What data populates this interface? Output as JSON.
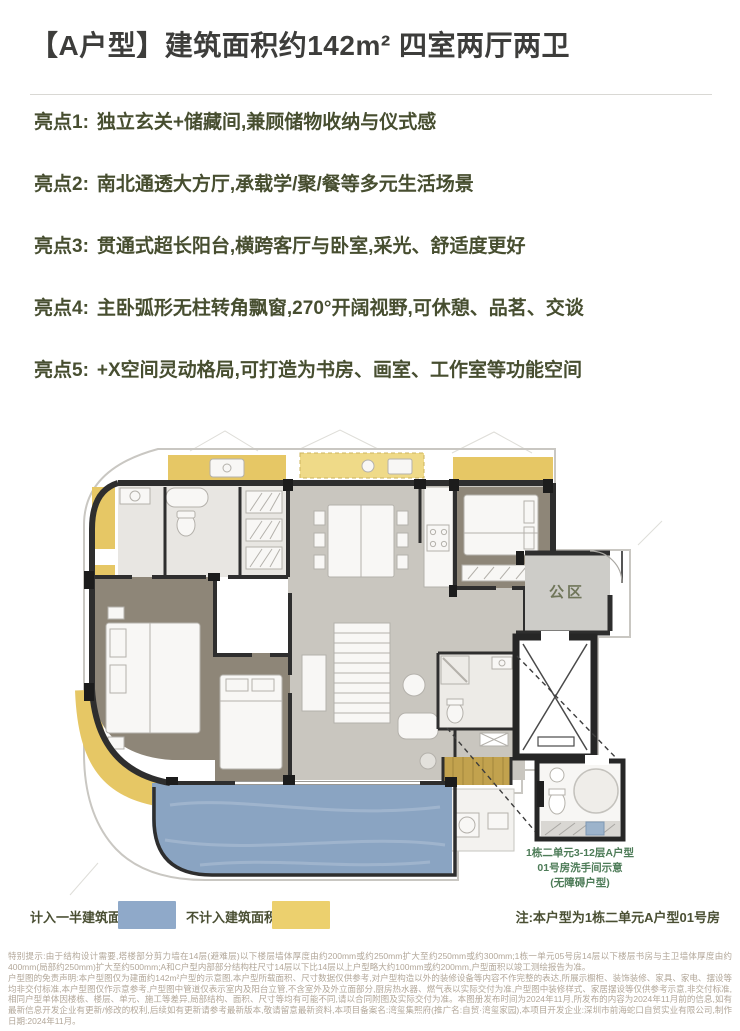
{
  "header": {
    "title": "【A户型】建筑面积约142m² 四室两厅两卫"
  },
  "highlights": [
    {
      "label": "亮点1:",
      "text": "独立玄关+储藏间,兼顾储物收纳与仪式感"
    },
    {
      "label": "亮点2:",
      "text": "南北通透大方厅,承载学/聚/餐等多元生活场景"
    },
    {
      "label": "亮点3:",
      "text": "贯通式超长阳台,横跨客厅与卧室,采光、舒适度更好"
    },
    {
      "label": "亮点4:",
      "text": "主卧弧形无柱转角飘窗,270°开阔视野,可休憩、品茗、交谈"
    },
    {
      "label": "亮点5:",
      "text": "+X空间灵动格局,可打造为书房、画室、工作室等功能空间"
    }
  ],
  "floorplan": {
    "public_area_label": "公区",
    "inset_caption": [
      "1栋二单元3-12层A户型",
      "01号房洗手间示意",
      "(无障碍户型)"
    ]
  },
  "legend": {
    "items": [
      {
        "label": "计入一半建筑面积",
        "color": "#8fa9c9"
      },
      {
        "label": "不计入建筑面积",
        "color": "#ecd06e"
      }
    ],
    "note": "注:本户型为1栋二单元A户型01号房"
  },
  "disclaimer": {
    "p1": "特别提示:由于结构设计需要,塔楼部分剪力墙在14层(避难层)以下楼层墙体厚度由约200mm或约250mm扩大至约250mm或约300mm;1栋一单元05号房14层以下楼层书房与主卫墙体厚度由约400mm(局部约250mm)扩大至约500mm;A和C户型内部部分结构柱尺寸14层以下比14层以上户型略大约100mm或约200mm,户型面积以竣工测绘报告为准。",
    "p2": "户型图的免责声明:本户型图仅为建面约142m²户型的示意图,本户型所载面积、尺寸数据仅供参考,对户型构造以外的装修设备等内容不作完整的表达,所展示橱柜、装饰装修、家具、家电、摆设等均非交付标准,本户型图仅作示意参考,户型图中管道仅表示室内及阳台立管,不含室外及外立面部分,厨房热水器、燃气表以实际交付为准,户型图中装修样式、家居摆设等仅供参考示意,非交付标准,相同户型单体因楼栋、楼层、单元、施工等差异,局部结构、面积、尺寸等均有可能不同,请以合同附图及实际交付为准。本图册发布时间为2024年11月,所发布的内容为2024年11月前的信息,如有最新信息开发企业有更新/修改的权利,后续如有更新请参考最新版本,敬请留意最新资料,本项目备案名:湾玺集熙府(推广名:自贸·湾玺家园),本项目开发企业:深圳市前海蛇口自贸实业有限公司,制作日期:2024年11月。"
  },
  "colors": {
    "half_area_blue": "#8fa9c9",
    "excluded_yellow": "#ecd06e",
    "wall_dark": "#2e2e2e",
    "bedroom_floor": "#8e8678",
    "living_floor": "#c9c6bf",
    "balcony_blue": "#8aa4c2",
    "highlight_text": "#474e30",
    "caption_green": "#4e7c58"
  }
}
